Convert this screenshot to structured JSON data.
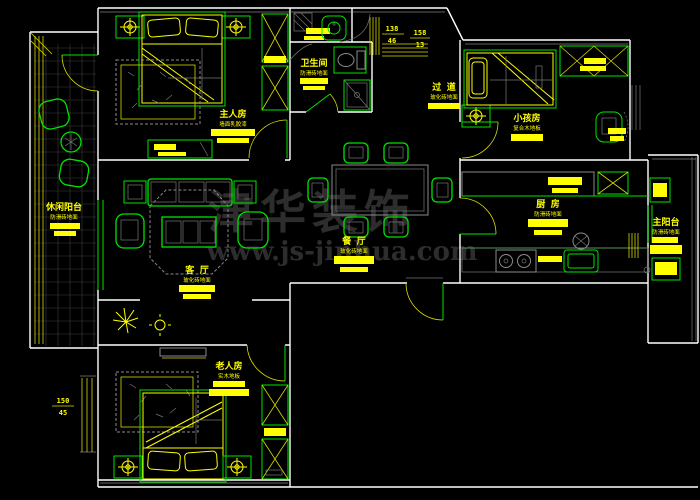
{
  "watermark": {
    "brand": "津华装饰",
    "site": "www.js-jinhua.com"
  },
  "rooms": {
    "master_bedroom": {
      "label": "主人房",
      "material": "墙面乳胶漆"
    },
    "bathroom": {
      "label": "卫生间",
      "material": "防滑砖地面"
    },
    "kids_room": {
      "label": "小孩房",
      "material": "复合木地板"
    },
    "kitchen": {
      "label": "厨 房",
      "material": "防滑砖地面"
    },
    "main_balcony": {
      "label": "主阳台",
      "material": "防滑砖地面"
    },
    "dining_room": {
      "label": "餐 厅",
      "material": "玻化砖地面"
    },
    "living_room": {
      "label": "客 厅",
      "material": "玻化砖地面"
    },
    "elder_room": {
      "label": "老人房",
      "material": "实木地板"
    },
    "leisure_balcony": {
      "label": "休闲阳台",
      "material": "防滑砖地面"
    },
    "hallway": {
      "label": "过 道",
      "material": "玻化砖地面"
    }
  },
  "dims": {
    "d1_a": "138",
    "d1_b": "46",
    "d2_a": "158",
    "d2_b": "13",
    "d3_a": "150",
    "d3_b": "45"
  },
  "colors": {
    "background": "#000000",
    "wall": "#ffffff",
    "furniture_green": "#00e400",
    "annotation_yellow": "#ffff00",
    "furniture_gray": "#8a8a8a",
    "watermark_gray": "#2d2d2d"
  }
}
